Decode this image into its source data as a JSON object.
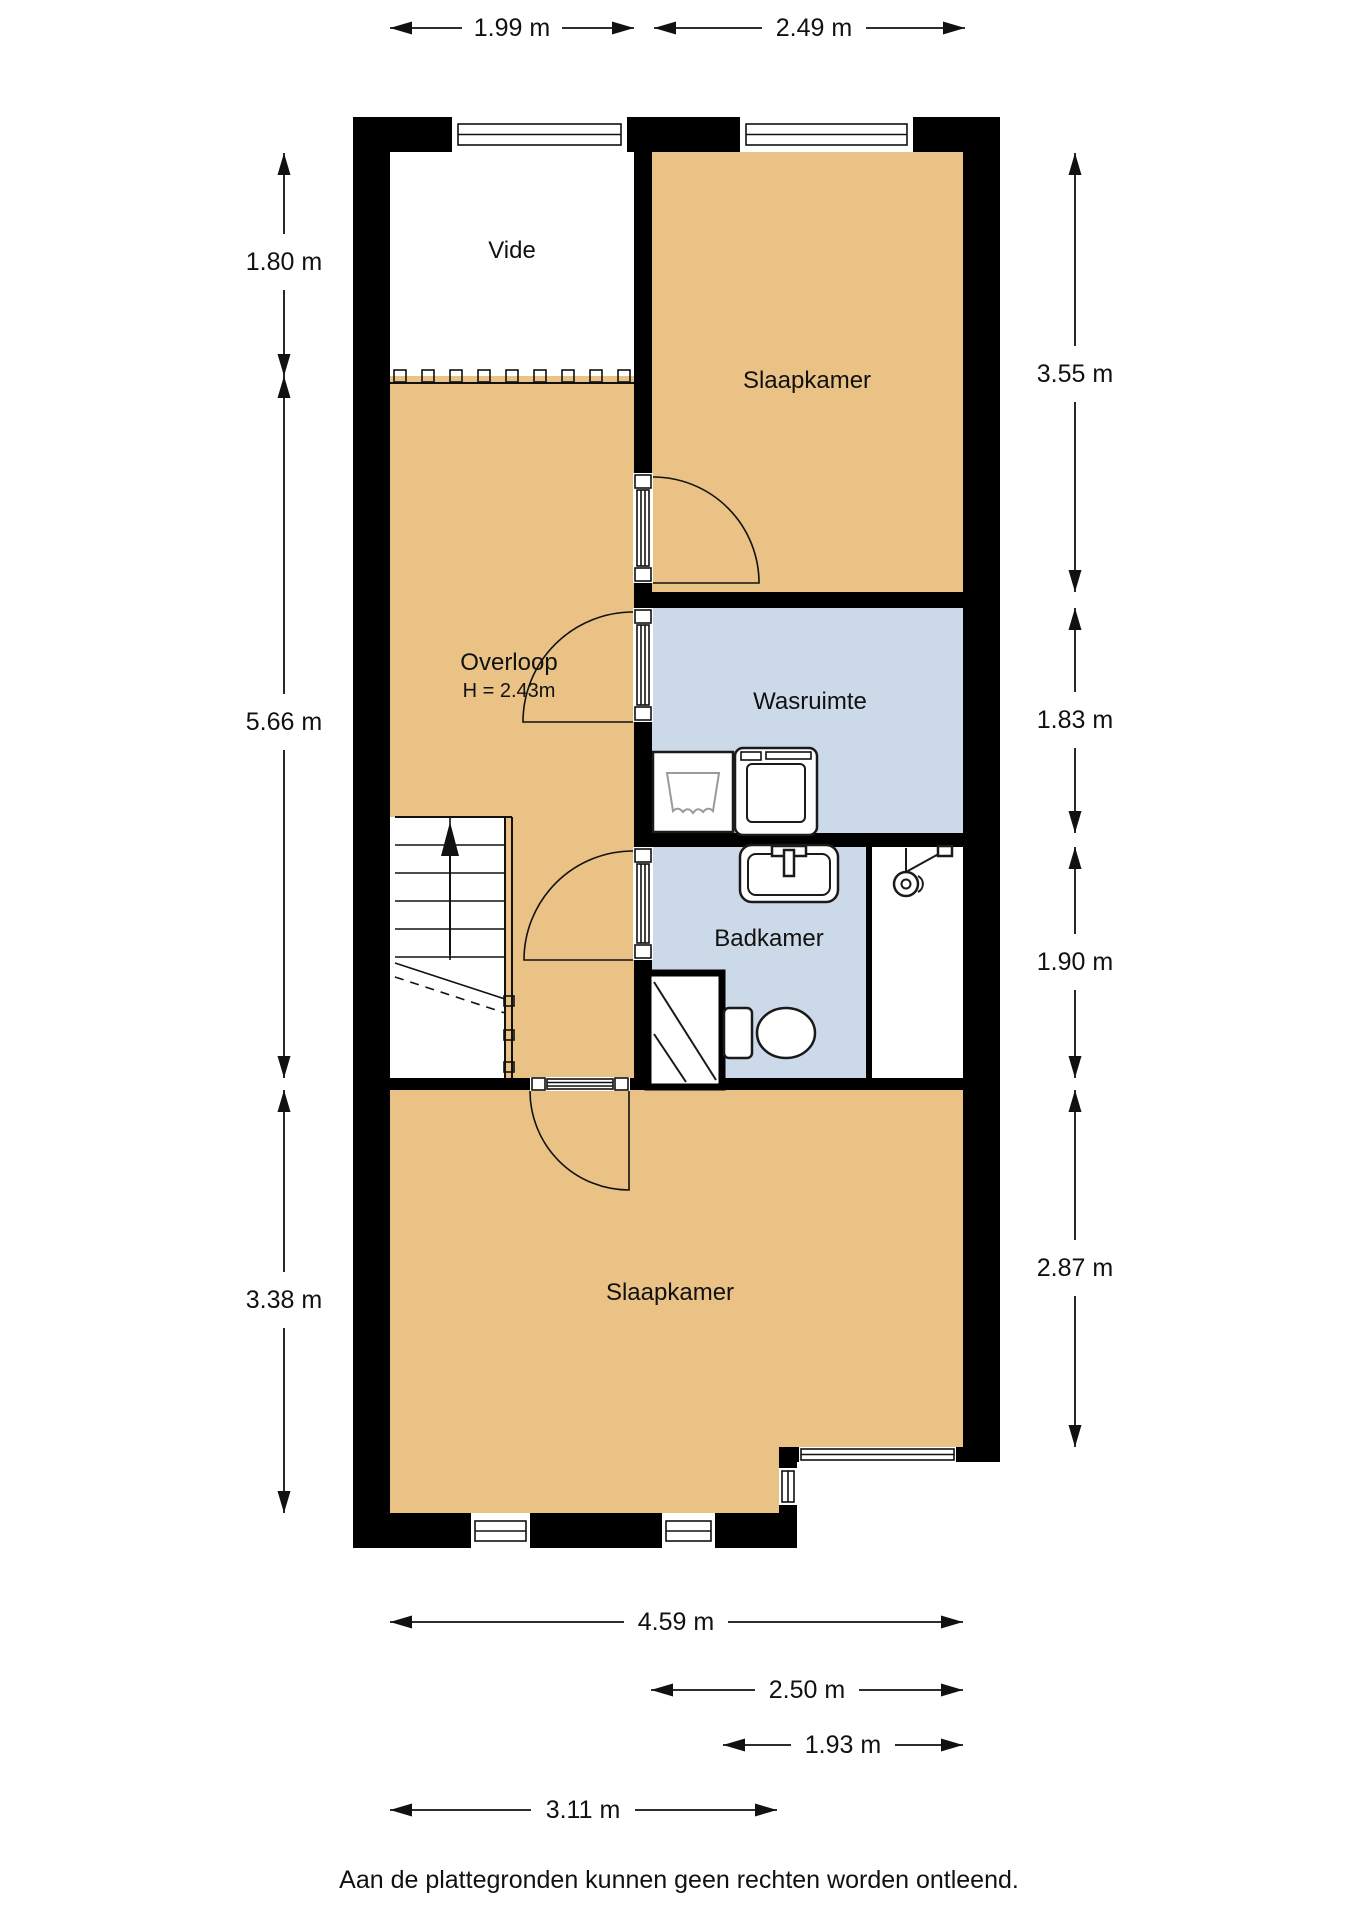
{
  "rooms": {
    "vide": {
      "label": "Vide"
    },
    "slaapkamer_top": {
      "label": "Slaapkamer"
    },
    "overloop": {
      "label": "Overloop",
      "height_note": "H = 2.43m"
    },
    "wasruimte": {
      "label": "Wasruimte"
    },
    "badkamer": {
      "label": "Badkamer"
    },
    "slaapkamer_bottom": {
      "label": "Slaapkamer"
    }
  },
  "dimensions": {
    "top": [
      {
        "label": "1.99 m"
      },
      {
        "label": "2.49 m"
      }
    ],
    "left": [
      {
        "label": "1.80 m"
      },
      {
        "label": "5.66 m"
      },
      {
        "label": "3.38 m"
      }
    ],
    "right": [
      {
        "label": "3.55 m"
      },
      {
        "label": "1.83 m"
      },
      {
        "label": "1.90 m"
      },
      {
        "label": "2.87 m"
      }
    ],
    "bottom": [
      {
        "label": "4.59 m"
      },
      {
        "label": "2.50 m"
      },
      {
        "label": "1.93 m"
      },
      {
        "label": "3.11 m"
      }
    ]
  },
  "footer": {
    "disclaimer": "Aan de plattegronden kunnen geen rechten worden ontleend."
  },
  "colors": {
    "room_warm": "#EAC286",
    "room_wet": "#CCD9E9",
    "wall": "#000000",
    "background": "#FFFFFF"
  }
}
